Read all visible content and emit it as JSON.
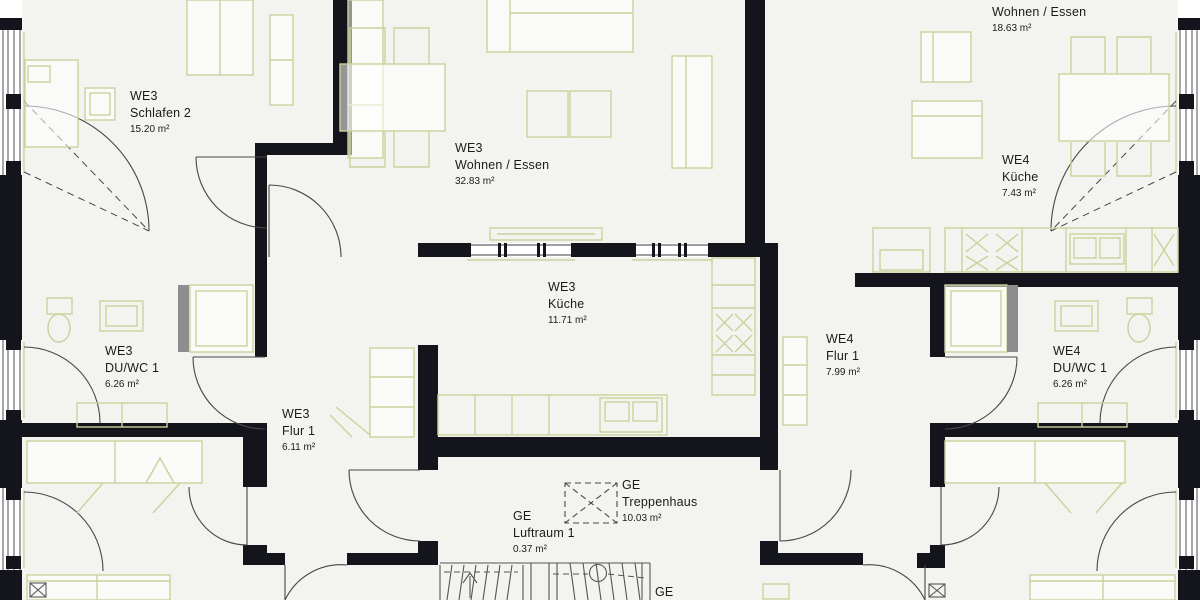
{
  "plan": {
    "title": "floor-plan",
    "labels": [
      {
        "unit": "WE3",
        "name": "Schlafen 2",
        "area": "15.20 m²",
        "x": 130,
        "y": 88
      },
      {
        "unit": "WE3",
        "name": "Wohnen / Essen",
        "area": "32.83 m²",
        "x": 455,
        "y": 140
      },
      {
        "unit": "",
        "name": "Wohnen / Essen",
        "area": "18.63 m²",
        "x": 992,
        "y": 4
      },
      {
        "unit": "WE4",
        "name": "Küche",
        "area": "7.43 m²",
        "x": 1002,
        "y": 152
      },
      {
        "unit": "WE3",
        "name": "Küche",
        "area": "11.71 m²",
        "x": 548,
        "y": 279
      },
      {
        "unit": "WE3",
        "name": "DU/WC 1",
        "area": "6.26 m²",
        "x": 105,
        "y": 343
      },
      {
        "unit": "WE4",
        "name": "Flur 1",
        "area": "7.99 m²",
        "x": 826,
        "y": 331
      },
      {
        "unit": "WE4",
        "name": "DU/WC 1",
        "area": "6.26 m²",
        "x": 1053,
        "y": 343
      },
      {
        "unit": "WE3",
        "name": "Flur 1",
        "area": "6.11 m²",
        "x": 282,
        "y": 406
      },
      {
        "unit": "GE",
        "name": "Treppenhaus",
        "area": "10.03 m²",
        "x": 622,
        "y": 477
      },
      {
        "unit": "GE",
        "name": "Luftraum 1",
        "area": "0.37 m²",
        "x": 513,
        "y": 508
      },
      {
        "unit": "GE",
        "name": "",
        "area": "",
        "x": 655,
        "y": 584
      }
    ]
  },
  "palette": {
    "wall": "#14141c",
    "floor": "#f3f3f0",
    "furniture": "#c9d29b",
    "door": "#474747",
    "shower_glass": "#8e8e8e",
    "stair": "#565656",
    "text": "#1b1b1b"
  }
}
